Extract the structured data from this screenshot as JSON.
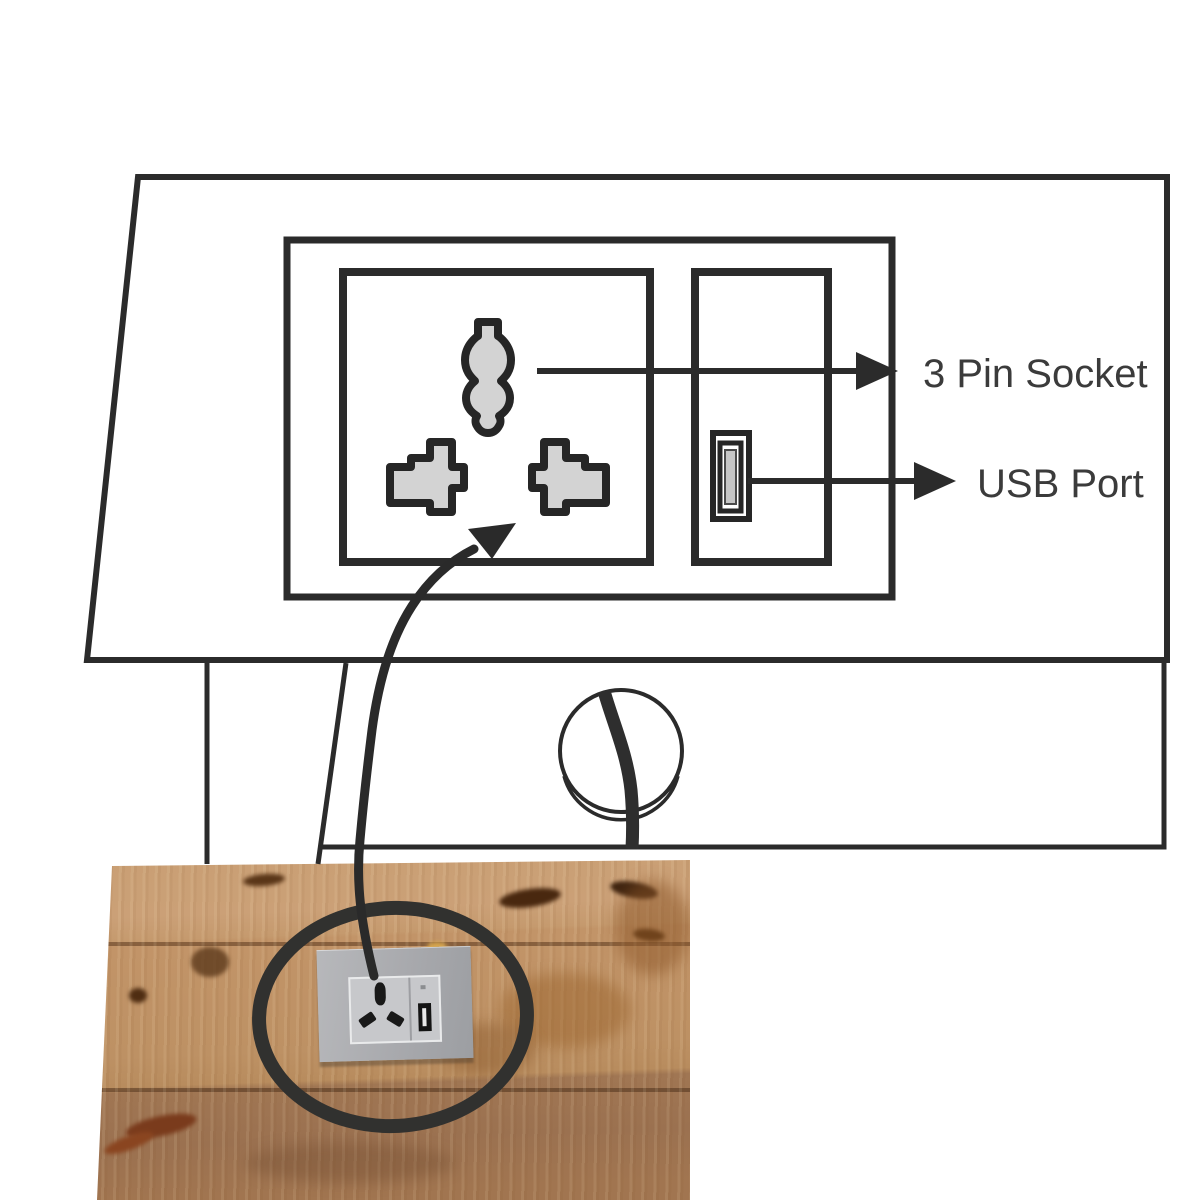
{
  "figure": {
    "kind": "product infographic of a desk with built-in power panel",
    "callouts": {
      "socket_label": "3 Pin Socket",
      "usb_label": "USB Port"
    },
    "elements": [
      "desk outline drawing",
      "power faceplate panel drawing",
      "3 pin socket hole drawing",
      "usb connector drawing",
      "cable grommet with cable",
      "curved leader arrow",
      "photo inset of wooden tabletop with real socket plate",
      "annotation circle on photo"
    ]
  },
  "icons": {
    "three-pin-socket-icon": "gray earth/live/neutral hole shapes",
    "usb-port-icon": "nested rectangles with tongue",
    "cable-grommet-icon": "double circle with cable band",
    "curved-arrow-icon": "swept arc with solid head",
    "annotation-circle-icon": "thick dark ellipse"
  },
  "colors": {
    "line": "#2b2b2b",
    "label_text": "#3b3b3b",
    "pin_fill": "#d3d3d3",
    "annotation": "#31312f",
    "plate_gray": "#a8a9ad",
    "wood_light": "#c99f74",
    "wood_mid": "#bd9164",
    "wood_dark": "#9b7150"
  }
}
